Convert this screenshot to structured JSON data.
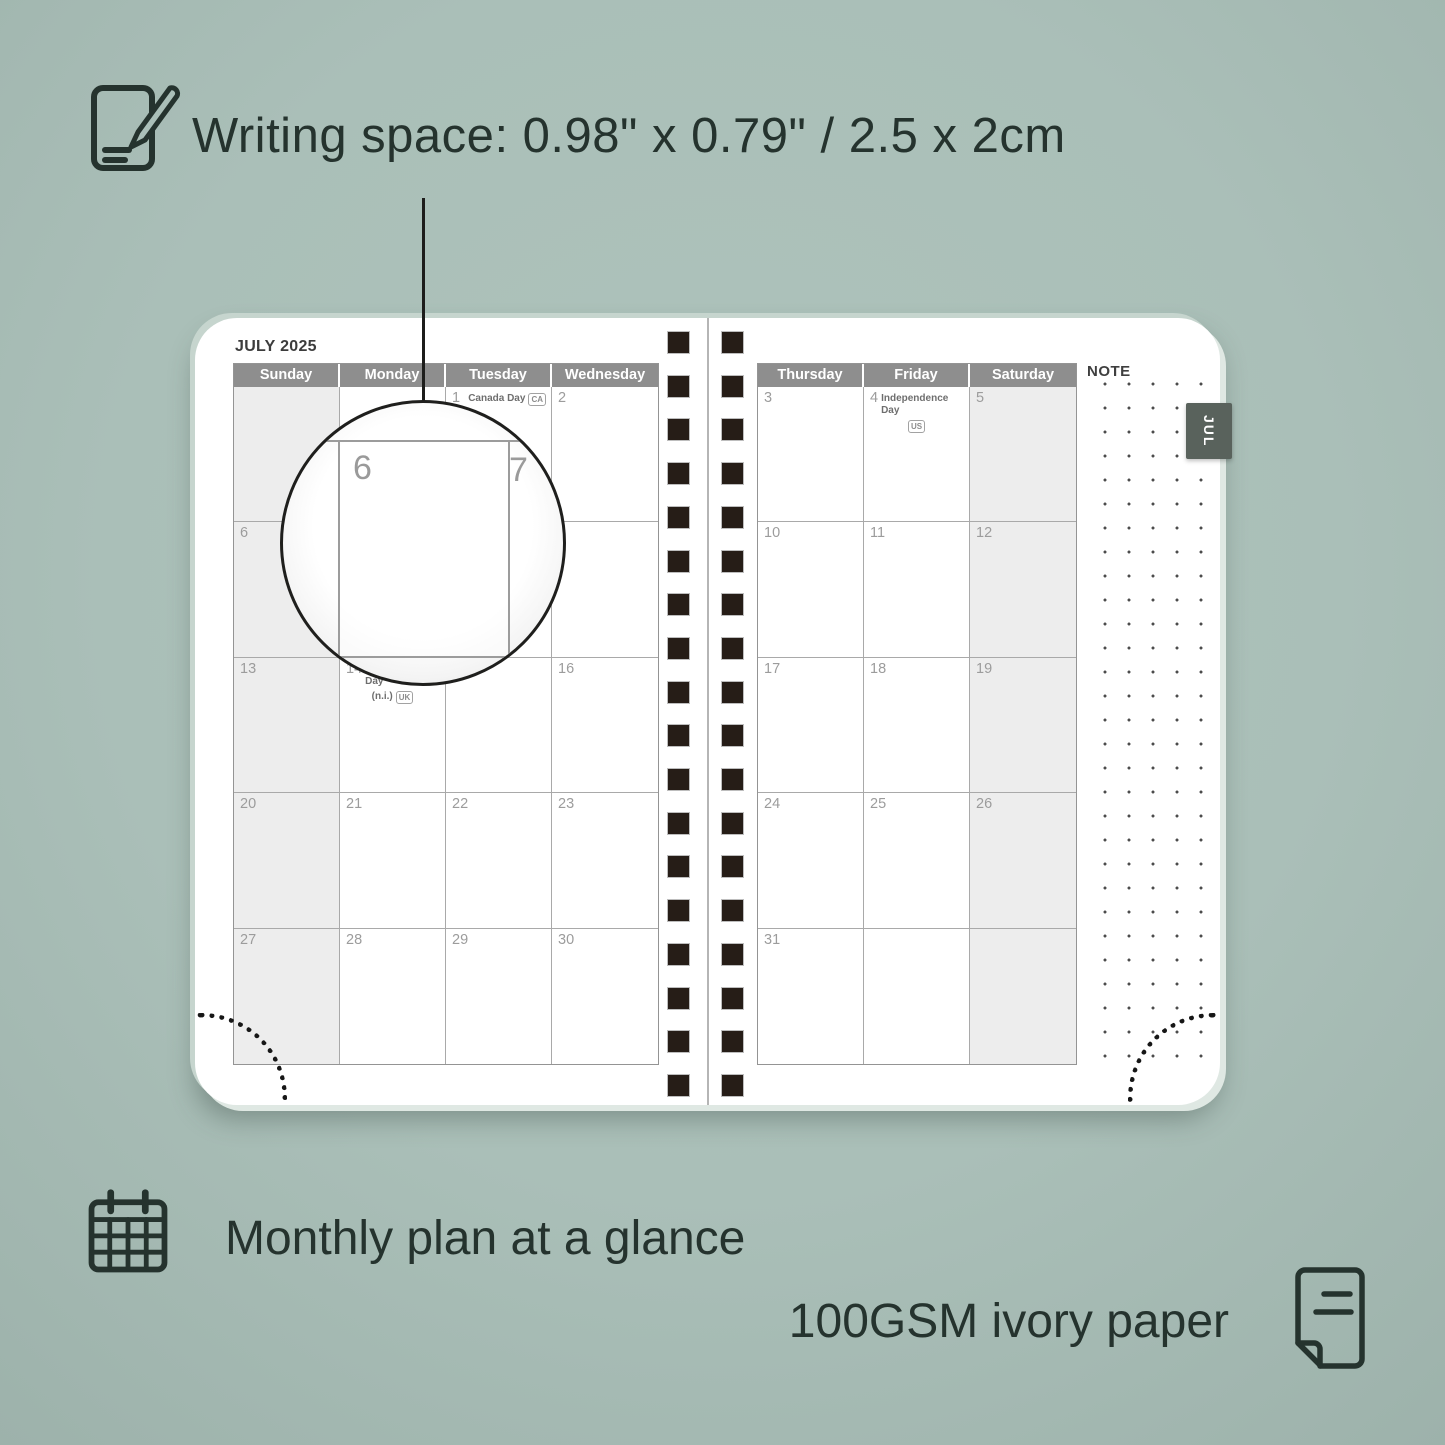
{
  "annotations": {
    "writing_space": "Writing space: 0.98\" x 0.79\" / 2.5 x 2cm",
    "monthly_plan": "Monthly plan at a glance",
    "paper": "100GSM ivory paper"
  },
  "colors": {
    "background": "#aabfb8",
    "annotation_text": "#25332e",
    "day_header_bg": "#8e8e8e",
    "weekend_shade": "#ededed",
    "binding_square": "#261d17",
    "month_tab_bg": "#59625c"
  },
  "planner": {
    "month_title": "JULY 2025",
    "tab_label": "JUL",
    "note_label": "NOTE",
    "left_day_headers": [
      "Sunday",
      "Monday",
      "Tuesday",
      "Wednesday"
    ],
    "right_day_headers": [
      "Thursday",
      "Friday",
      "Saturday"
    ],
    "left_weeks": [
      [
        {},
        {},
        {
          "day": "1",
          "holiday": "Canada Day",
          "badge_inline": "CA"
        },
        {
          "day": "2"
        }
      ],
      [
        {
          "day": "6"
        },
        {
          "day": "7"
        },
        {
          "day": "8"
        },
        {
          "day": "9"
        }
      ],
      [
        {
          "day": "13"
        },
        {
          "day": "14",
          "holiday": "Orangemen's Day",
          "line2_text": "(n.i.)",
          "line2_badge": "UK"
        },
        {
          "day": "15"
        },
        {
          "day": "16"
        }
      ],
      [
        {
          "day": "20"
        },
        {
          "day": "21"
        },
        {
          "day": "22"
        },
        {
          "day": "23"
        }
      ],
      [
        {
          "day": "27"
        },
        {
          "day": "28"
        },
        {
          "day": "29"
        },
        {
          "day": "30"
        }
      ]
    ],
    "right_weeks": [
      [
        {
          "day": "3"
        },
        {
          "day": "4",
          "holiday": "Independence Day",
          "line2_badge": "US"
        },
        {
          "day": "5"
        }
      ],
      [
        {
          "day": "10"
        },
        {
          "day": "11"
        },
        {
          "day": "12"
        }
      ],
      [
        {
          "day": "17"
        },
        {
          "day": "18"
        },
        {
          "day": "19"
        }
      ],
      [
        {
          "day": "24"
        },
        {
          "day": "25"
        },
        {
          "day": "26"
        }
      ],
      [
        {
          "day": "31"
        },
        {},
        {}
      ]
    ],
    "magnifier": {
      "left_number": "6",
      "right_number": "7"
    }
  }
}
